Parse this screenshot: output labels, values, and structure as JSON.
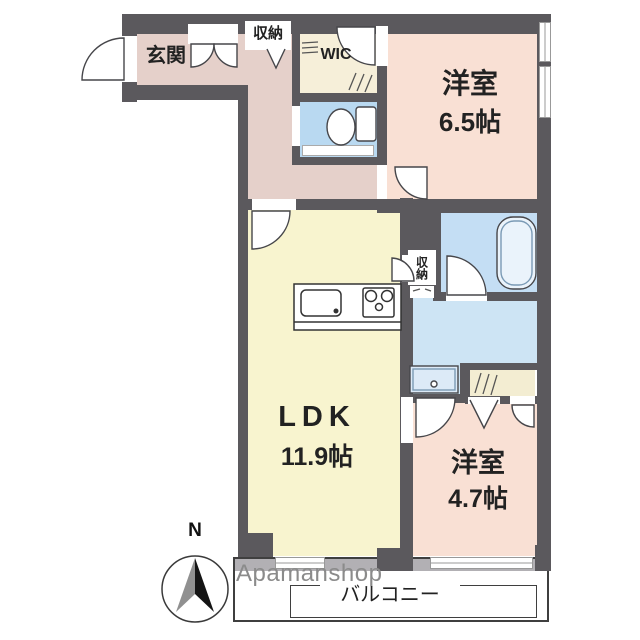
{
  "watermark": "Apamanshop",
  "compass": {
    "north_label": "N"
  },
  "rooms": {
    "entrance": {
      "label": "玄関"
    },
    "storage_top": {
      "label": "収納"
    },
    "wic": {
      "label": "WIC"
    },
    "bedroom_1": {
      "label": "洋室",
      "size": "6.5帖"
    },
    "ldk": {
      "label": "LDK",
      "size": "11.9帖"
    },
    "storage_mid": {
      "label": "収納"
    },
    "bedroom_2": {
      "label": "洋室",
      "size": "4.7帖"
    },
    "balcony": {
      "label": "バルコニー"
    }
  },
  "colors": {
    "wall": "#5b595d",
    "entrance_corridor": "#e5d0ca",
    "bedroom": "#f9e0d4",
    "ldk": "#f8f4cf",
    "wic": "#f6efd9",
    "closet": "#f3edd2",
    "toilet": "#b9d9f1",
    "bathroom": "#c4def4",
    "washroom": "#cde4f4",
    "balcony_band": "#b2b0b4",
    "watermark_gray": "#8b8b8b"
  }
}
